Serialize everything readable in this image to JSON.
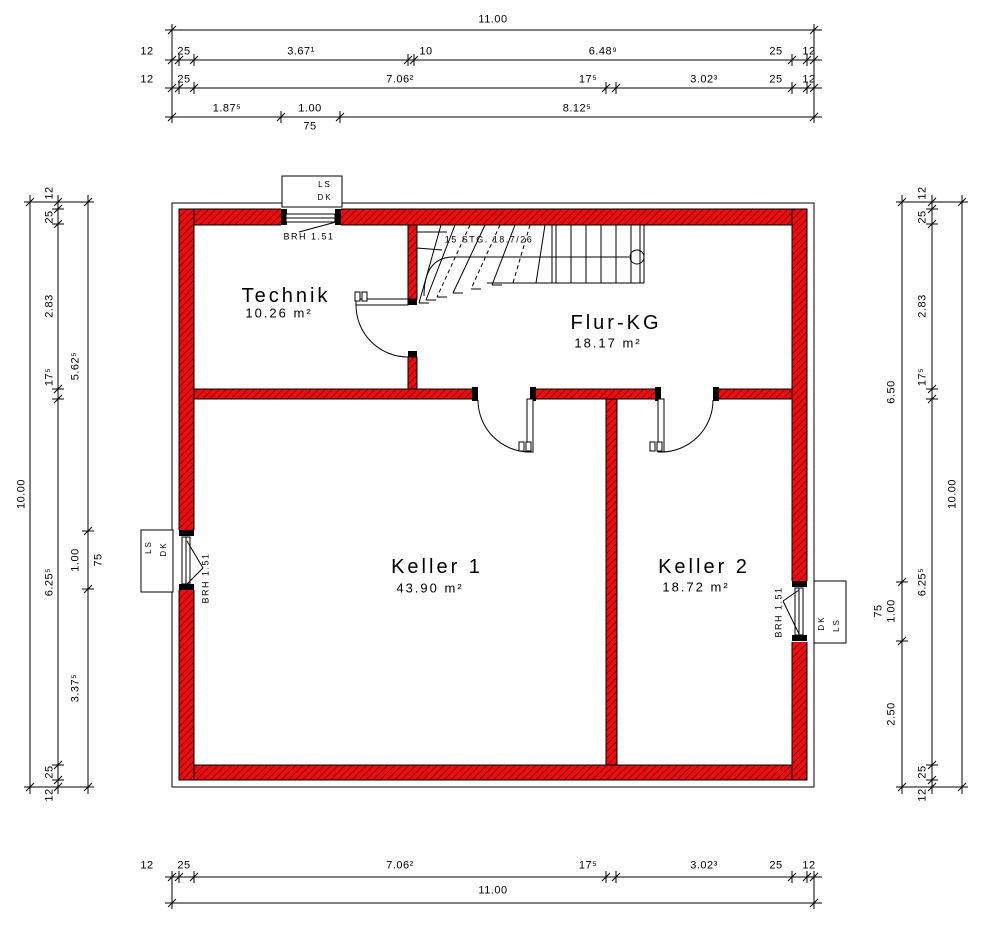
{
  "colors": {
    "wall": "#ea0e10",
    "line": "#000000"
  },
  "rooms": {
    "technik": {
      "name": "Technik",
      "area": "10.26 m²"
    },
    "flur": {
      "name": "Flur-KG",
      "area": "18.17 m²"
    },
    "keller1": {
      "name": "Keller 1",
      "area": "43.90 m²"
    },
    "keller2": {
      "name": "Keller 2",
      "area": "18.72 m²"
    }
  },
  "stair": {
    "label": "15 STG. 18.7/26"
  },
  "windows": {
    "top": {
      "l1": "LS",
      "l2": "DK",
      "sill": "BRH 1.51"
    },
    "left": {
      "l1": "LS",
      "l2": "DK",
      "sill": "BRH 1.51"
    },
    "right": {
      "l1": "DK",
      "l2": "LS",
      "sill": "BRH 1.51"
    }
  },
  "dims": {
    "top": {
      "total": "11.00",
      "row2": [
        "12",
        "25",
        "3.67¹",
        "10",
        "6.48⁹",
        "25",
        "12"
      ],
      "row3": [
        "12",
        "25",
        "7.06²",
        "17⁵",
        "3.02³",
        "25",
        "12"
      ],
      "row4": [
        "1.87⁵",
        "1.00",
        "8.12⁵"
      ],
      "row4_sub": "75"
    },
    "bottom": {
      "row1": [
        "12",
        "25",
        "7.06²",
        "17⁵",
        "3.02³",
        "25",
        "12"
      ],
      "total": "11.00"
    },
    "left": {
      "total": "10.00",
      "middle": [
        "12",
        "25",
        "2.83",
        "17⁵",
        "6.25⁵",
        "25",
        "12"
      ],
      "inner": [
        "5.62⁵",
        "1.00",
        "3.37⁵"
      ],
      "inner_sub": "75"
    },
    "right": {
      "total": "10.00",
      "middle": [
        "12",
        "25",
        "2.83",
        "17⁵",
        "6.25⁵",
        "25",
        "12"
      ],
      "inner": [
        "6.50",
        "1.00",
        "2.50"
      ],
      "inner_sub": "75"
    }
  }
}
